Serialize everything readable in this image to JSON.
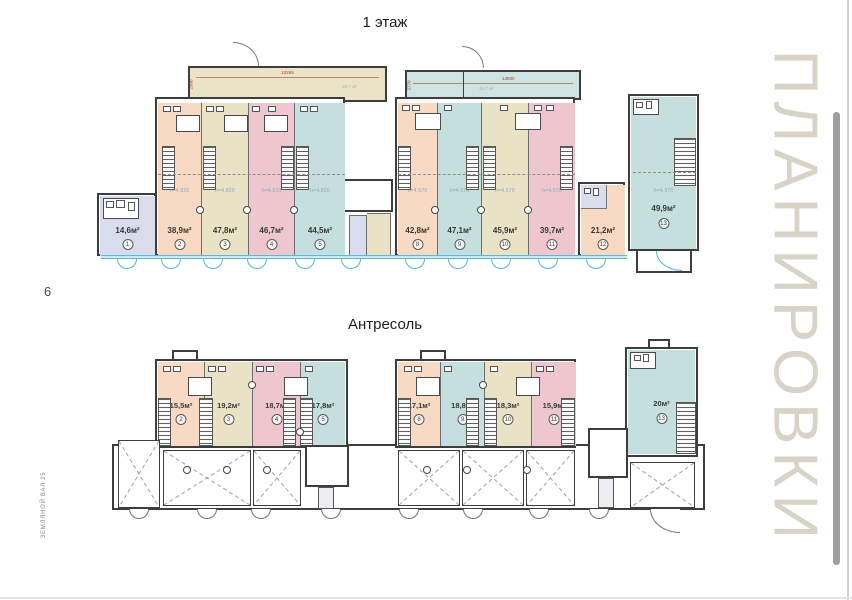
{
  "page": {
    "number": "6",
    "side_label": "ЗЕМЛЯНОЙ ВАЛ 25",
    "watermark": "ПЛАНИРОВКИ"
  },
  "palette": {
    "salmon": "#f8d9c3",
    "tan": "#eae2c4",
    "rose": "#eec7ce",
    "teal": "#c4dfdd",
    "lavender": "#d8dcec",
    "wall": "#3d3d3d",
    "door_blue": "#55b5d3",
    "watermark_text": "#d9d2c6"
  },
  "floor1": {
    "title": "1 этаж",
    "annex_left": {
      "length": "10265",
      "depth": "2900",
      "area": "29.7 м²"
    },
    "annex_right": {
      "length": "13930",
      "depth": "2770",
      "area": "36.7 м²"
    },
    "rooms": [
      {
        "num": "1",
        "area": "14,6м²",
        "h": ""
      },
      {
        "num": "2",
        "area": "38,9м²",
        "h": "h=4,820"
      },
      {
        "num": "3",
        "area": "47,8м²",
        "h": "h=4,820"
      },
      {
        "num": "4",
        "area": "46,7м²",
        "h": "h=4,820"
      },
      {
        "num": "5",
        "area": "44,5м²",
        "h": "h=4,820"
      },
      {
        "num": "8",
        "area": "42,8м²",
        "h": "h=4,570"
      },
      {
        "num": "9",
        "area": "47,1м²",
        "h": "h=4,570"
      },
      {
        "num": "10",
        "area": "45,9м²",
        "h": "h=4,570"
      },
      {
        "num": "11",
        "area": "39,7м²",
        "h": "h=4,570"
      },
      {
        "num": "12",
        "area": "21,2м²",
        "h": ""
      },
      {
        "num": "13",
        "area": "49,9м²",
        "h": "h=4,370"
      }
    ]
  },
  "mezzanine": {
    "title": "Антресоль",
    "rooms": [
      {
        "num": "2",
        "area": "15,5м²"
      },
      {
        "num": "3",
        "area": "19,2м²"
      },
      {
        "num": "4",
        "area": "18,7м²"
      },
      {
        "num": "5",
        "area": "17,8м²"
      },
      {
        "num": "8",
        "area": "17,1м²"
      },
      {
        "num": "9",
        "area": "18,8м²"
      },
      {
        "num": "10",
        "area": "18,3м²"
      },
      {
        "num": "11",
        "area": "15,9м²"
      },
      {
        "num": "13",
        "area": "20м²"
      }
    ]
  }
}
